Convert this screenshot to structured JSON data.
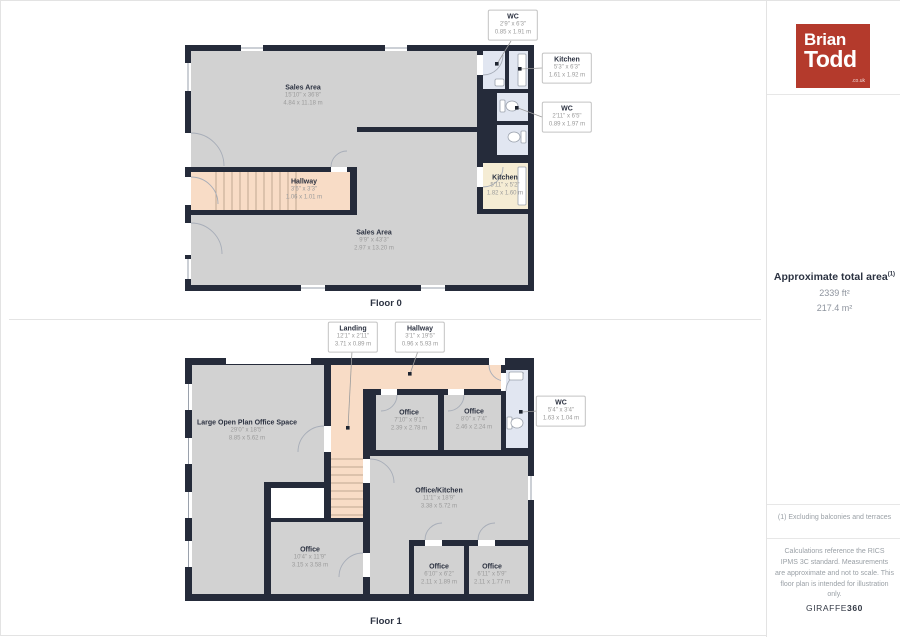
{
  "sidebar": {
    "logo": {
      "line1": "Brian",
      "line2": "Todd",
      "suffix": ".co.uk"
    },
    "area": {
      "label": "Approximate total area",
      "sup": "(1)",
      "ft": "2339 ft²",
      "m": "217.4 m²"
    },
    "footnote": "(1) Excluding balconies and terraces",
    "disclaimer": "Calculations reference the RICS IPMS 3C standard. Measurements are approximate and not to scale. This floor plan is intended for illustration only.",
    "brand": {
      "regular": "GIRAFFE",
      "bold": "360"
    }
  },
  "floor0": {
    "label": "Floor 0",
    "rooms": {
      "sales_top": {
        "name": "Sales Area",
        "imperial": "15'10\" x 36'8\"",
        "metric": "4.84 x 11.18 m"
      },
      "hallway": {
        "name": "Hallway",
        "imperial": "3'6\" x 3'3\"",
        "metric": "1.06 x 1.01 m"
      },
      "sales_bottom": {
        "name": "Sales Area",
        "imperial": "9'9\" x 43'3\"",
        "metric": "2.97 x 13.20 m"
      },
      "kitchen": {
        "name": "Kitchen",
        "imperial": "5'11\" x 5'2\"",
        "metric": "1.82 x 1.60 m"
      }
    },
    "callouts": {
      "wc_top": {
        "name": "WC",
        "imperial": "2'9\" x 6'3\"",
        "metric": "0.85 x 1.91 m"
      },
      "kitchen_small": {
        "name": "Kitchen",
        "imperial": "5'3\" x 6'3\"",
        "metric": "1.61 x 1.92 m"
      },
      "wc_right": {
        "name": "WC",
        "imperial": "2'11\" x 6'5\"",
        "metric": "0.89 x 1.97 m"
      }
    }
  },
  "floor1": {
    "label": "Floor 1",
    "rooms": {
      "large_office": {
        "name": "Large Open Plan Office Space",
        "imperial": "29'0\" x 18'5\"",
        "metric": "8.85 x 5.62 m"
      },
      "office_a": {
        "name": "Office",
        "imperial": "7'10\" x 9'1\"",
        "metric": "2.39 x 2.78 m"
      },
      "office_b": {
        "name": "Office",
        "imperial": "8'0\" x 7'4\"",
        "metric": "2.46 x 2.24 m"
      },
      "office_kitchen": {
        "name": "Office/Kitchen",
        "imperial": "11'1\" x 18'9\"",
        "metric": "3.38 x 5.72 m"
      },
      "office_center": {
        "name": "Office",
        "imperial": "10'4\" x 11'9\"",
        "metric": "3.15 x 3.58 m"
      },
      "office_bl": {
        "name": "Office",
        "imperial": "6'10\" x 6'2\"",
        "metric": "2.11 x 1.89 m"
      },
      "office_br": {
        "name": "Office",
        "imperial": "6'11\" x 5'9\"",
        "metric": "2.11 x 1.77 m"
      }
    },
    "callouts": {
      "landing": {
        "name": "Landing",
        "imperial": "12'1\" x 2'11\"",
        "metric": "3.71 x 0.89 m"
      },
      "hallway": {
        "name": "Hallway",
        "imperial": "3'1\" x 19'5\"",
        "metric": "0.96 x 5.93 m"
      },
      "wc": {
        "name": "WC",
        "imperial": "5'4\" x 3'4\"",
        "metric": "1.63 x 1.04 m"
      }
    }
  },
  "colors": {
    "wall": "#252b3a",
    "room": "#d2d2d2",
    "hall": "#f8dcc6",
    "wet": "#e1e6f1",
    "kitchen": "#f5ecd4",
    "logo_red": "#b43a2c"
  }
}
